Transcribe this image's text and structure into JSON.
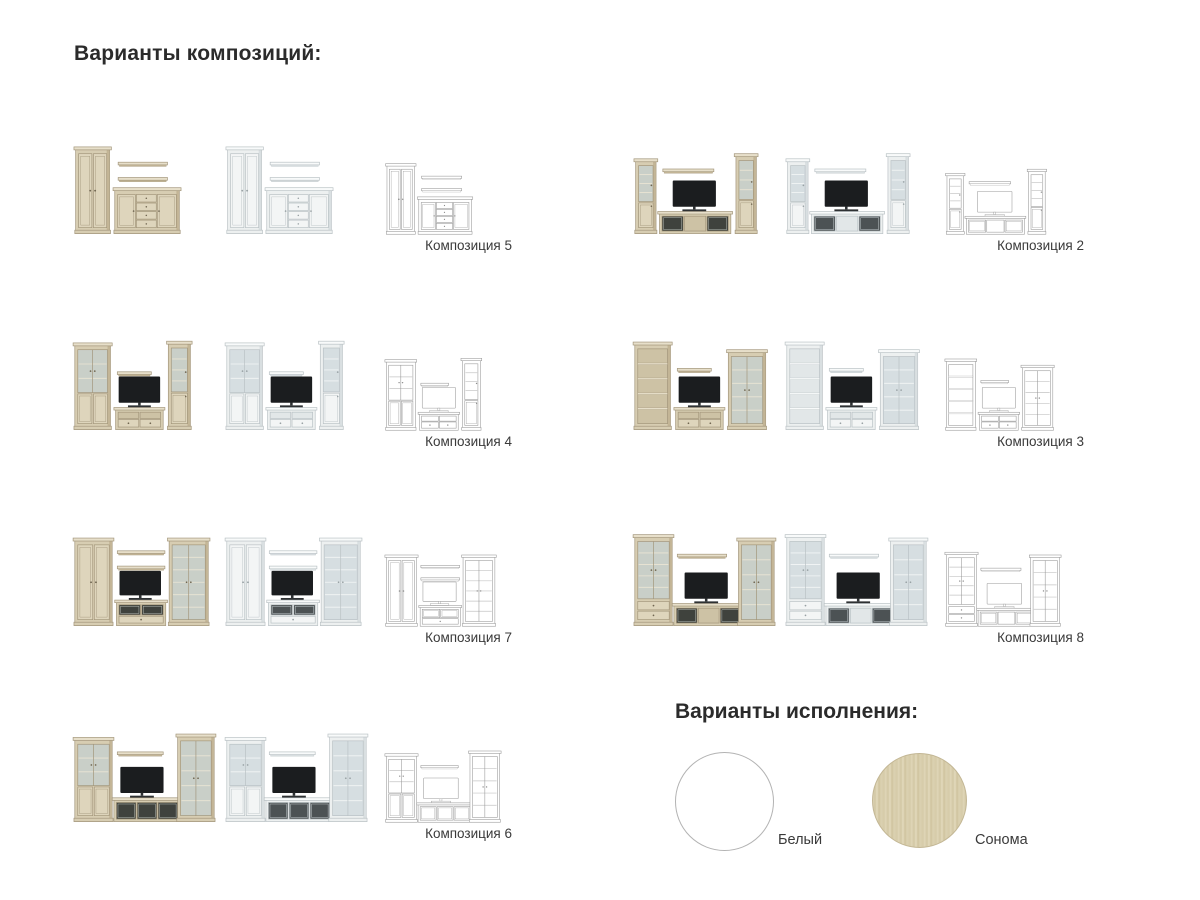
{
  "headings": {
    "compositions": "Варианты композиций:",
    "finishes": "Варианты исполнения:"
  },
  "variant_order": [
    "sonoma",
    "white",
    "outline"
  ],
  "finishes": {
    "title": "Варианты исполнения:",
    "options": [
      {
        "label": "Белый",
        "color": "#ffffff"
      },
      {
        "label": "Сонома",
        "color": "#d6cbaa"
      }
    ]
  },
  "render_palettes": {
    "sonoma": {
      "body": "#d7cdb2",
      "body2": "#ded5bc",
      "top": "#e7dfca",
      "side": "#c3b596",
      "inner": "#cdc2a5",
      "stroke": "#a2957a",
      "line": "#ebe5d4",
      "glass": "#c9cfc8",
      "dark": "#3f423d",
      "knob": "#6f6550",
      "tv": "#1b1d1f",
      "tvStroke": "#1b1d1f",
      "tvbase": "#2e3133"
    },
    "white": {
      "body": "#edf0f0",
      "body2": "#f3f5f5",
      "top": "#f8fafa",
      "side": "#d9dfe1",
      "inner": "#e2e7e8",
      "stroke": "#b9c1c4",
      "line": "#f3f6f6",
      "glass": "#d6dee1",
      "dark": "#4c5254",
      "knob": "#98a1a4",
      "tv": "#1b1d1f",
      "tvStroke": "#1b1d1f",
      "tvbase": "#2e3133"
    },
    "outline": {
      "wire": true,
      "body": "#ffffff",
      "body2": "#ffffff",
      "top": "#ffffff",
      "side": "#ffffff",
      "inner": "#ffffff",
      "stroke": "#979797",
      "line": "#c4c4c4",
      "glass": "#ffffff",
      "dark": "#ffffff",
      "knob": "#8d8d8d",
      "tv": "#ffffff",
      "tvStroke": "#9a9a9a",
      "tvbase": "#ffffff"
    }
  },
  "compositions": [
    {
      "label": "Композиция 5",
      "col": 0,
      "row": 0,
      "pieces": [
        {
          "t": "cab",
          "style": "solid",
          "x": 4,
          "y": 14,
          "w": 40,
          "h": 102
        },
        {
          "t": "shelf",
          "x": 54,
          "y": 32,
          "w": 58
        },
        {
          "t": "shelf",
          "x": 54,
          "y": 50,
          "w": 58
        },
        {
          "t": "sideboard",
          "x": 50,
          "y": 62,
          "w": 76,
          "h": 54
        }
      ]
    },
    {
      "label": "Композиция 2",
      "col": 1,
      "row": 0,
      "pieces": [
        {
          "t": "cab",
          "style": "glasssolid",
          "rows": 3,
          "x": 4,
          "y": 28,
          "w": 24,
          "h": 88
        },
        {
          "t": "shelf",
          "x": 36,
          "y": 40,
          "w": 60
        },
        {
          "t": "tvstand",
          "x": 32,
          "y": 90,
          "w": 84,
          "h": 26,
          "fronts": [
            "glass",
            "open",
            "glass"
          ]
        },
        {
          "t": "tv",
          "x": 48,
          "y": 54,
          "w": 50,
          "h": 30
        },
        {
          "t": "cab",
          "style": "glasssolid",
          "rows": 3,
          "x": 122,
          "y": 22,
          "w": 24,
          "h": 94
        }
      ]
    },
    {
      "label": "Композиция 4",
      "col": 0,
      "row": 1,
      "pieces": [
        {
          "t": "cab",
          "style": "glasssolid",
          "rows": 2,
          "x": 3,
          "y": 14,
          "w": 42,
          "h": 102
        },
        {
          "t": "shelf",
          "x": 53,
          "y": 48,
          "w": 40
        },
        {
          "t": "tvstand",
          "x": 51,
          "y": 90,
          "w": 56,
          "h": 26,
          "fronts": [
            "drawer",
            "drawer"
          ]
        },
        {
          "t": "tv",
          "x": 55,
          "y": 54,
          "w": 48,
          "h": 30
        },
        {
          "t": "cab",
          "style": "glasssolid",
          "rows": 3,
          "x": 113,
          "y": 12,
          "w": 26,
          "h": 104
        }
      ]
    },
    {
      "label": "Композиция 3",
      "col": 1,
      "row": 1,
      "pieces": [
        {
          "t": "cab",
          "style": "open",
          "rows": 4,
          "x": 3,
          "y": 13,
          "w": 42,
          "h": 103
        },
        {
          "t": "shelf",
          "x": 53,
          "y": 44,
          "w": 40
        },
        {
          "t": "tvstand",
          "x": 51,
          "y": 90,
          "w": 56,
          "h": 26,
          "fronts": [
            "drawer",
            "drawer"
          ]
        },
        {
          "t": "tv",
          "x": 55,
          "y": 54,
          "w": 48,
          "h": 30
        },
        {
          "t": "cab",
          "style": "glass",
          "rows": 4,
          "x": 113,
          "y": 22,
          "w": 44,
          "h": 94
        }
      ]
    },
    {
      "label": "Композиция 7",
      "col": 0,
      "row": 2,
      "pieces": [
        {
          "t": "cab",
          "style": "solid",
          "x": 3,
          "y": 13,
          "w": 44,
          "h": 103
        },
        {
          "t": "shelf",
          "x": 53,
          "y": 28,
          "w": 56
        },
        {
          "t": "shelf",
          "x": 53,
          "y": 46,
          "w": 56
        },
        {
          "t": "tvstand",
          "x": 52,
          "y": 86,
          "w": 58,
          "h": 30,
          "fronts": [
            "glass",
            "glass"
          ],
          "bd": 1
        },
        {
          "t": "tv",
          "x": 56,
          "y": 52,
          "w": 48,
          "h": 28
        },
        {
          "t": "cab",
          "style": "glass",
          "rows": 5,
          "x": 114,
          "y": 13,
          "w": 46,
          "h": 103
        }
      ]
    },
    {
      "label": "Композиция 8",
      "col": 1,
      "row": 2,
      "pieces": [
        {
          "t": "cab",
          "style": "glass",
          "rows": 4,
          "dr": 2,
          "x": 3,
          "y": 9,
          "w": 44,
          "h": 107
        },
        {
          "t": "shelf",
          "x": 53,
          "y": 32,
          "w": 58
        },
        {
          "t": "tvstand",
          "x": 49,
          "y": 90,
          "w": 82,
          "h": 26,
          "fronts": [
            "glass",
            "open",
            "glass"
          ]
        },
        {
          "t": "tv",
          "x": 62,
          "y": 54,
          "w": 50,
          "h": 30
        },
        {
          "t": "cab",
          "style": "glass",
          "rows": 4,
          "x": 125,
          "y": 13,
          "w": 42,
          "h": 103
        }
      ]
    },
    {
      "label": "Композиция 6",
      "col": 0,
      "row": 3,
      "pieces": [
        {
          "t": "cab",
          "style": "glasssolid",
          "rows": 2,
          "x": 3,
          "y": 17,
          "w": 44,
          "h": 99
        },
        {
          "t": "shelf",
          "x": 53,
          "y": 34,
          "w": 54
        },
        {
          "t": "tvstand",
          "x": 49,
          "y": 88,
          "w": 78,
          "h": 28,
          "fronts": [
            "glass",
            "glass",
            "glass"
          ]
        },
        {
          "t": "tv",
          "x": 57,
          "y": 52,
          "w": 50,
          "h": 30
        },
        {
          "t": "cab",
          "style": "glass",
          "rows": 4,
          "x": 124,
          "y": 13,
          "w": 43,
          "h": 103
        }
      ]
    }
  ]
}
